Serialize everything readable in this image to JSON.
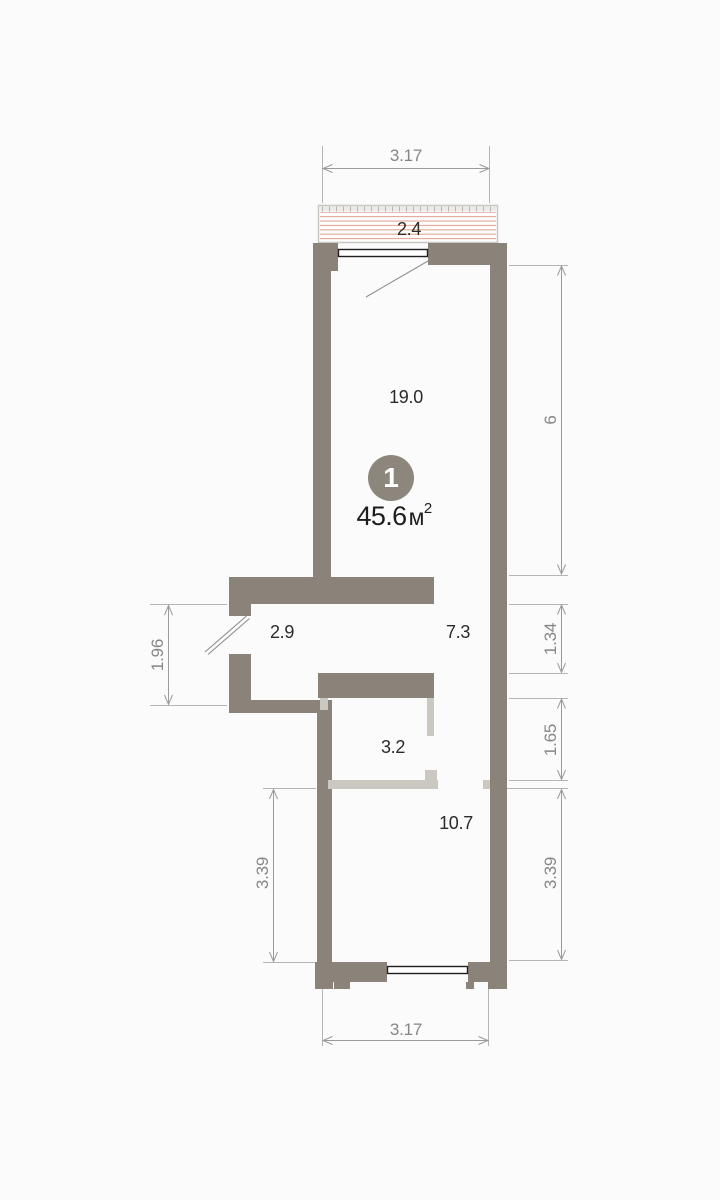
{
  "unit": {
    "number": "1",
    "area_value": "45.6",
    "area_unit": "м",
    "area_exp": "2"
  },
  "rooms": {
    "living": "19.0",
    "hall": "2.9",
    "corridor": "7.3",
    "bathroom": "3.2",
    "room2": "10.7",
    "balcony": "2.4"
  },
  "dimensions": {
    "top_width": "3.17",
    "bottom_width": "3.17",
    "right_living": "6",
    "right_hall": "1.34",
    "right_bath": "1.65",
    "right_room2": "3.39",
    "left_hall": "1.96",
    "left_room2": "3.39"
  },
  "colors": {
    "wall_dark": "#8b8379",
    "wall_light": "#cbc8c2",
    "balcony_stripe": "#e2a294",
    "balcony_band": "#edebe7",
    "balcony_tick": "#b9b6b0",
    "dim_line": "#9a9a9a",
    "ext_line": "#b5b5b5",
    "dim_text": "#868686",
    "room_text": "#2b2b2b",
    "badge_bg": "#8d867c",
    "badge_text": "#ffffff",
    "window_stroke": "#1f1f1f",
    "door_line": "#8f8f8f",
    "background": "#fbfbfb"
  }
}
